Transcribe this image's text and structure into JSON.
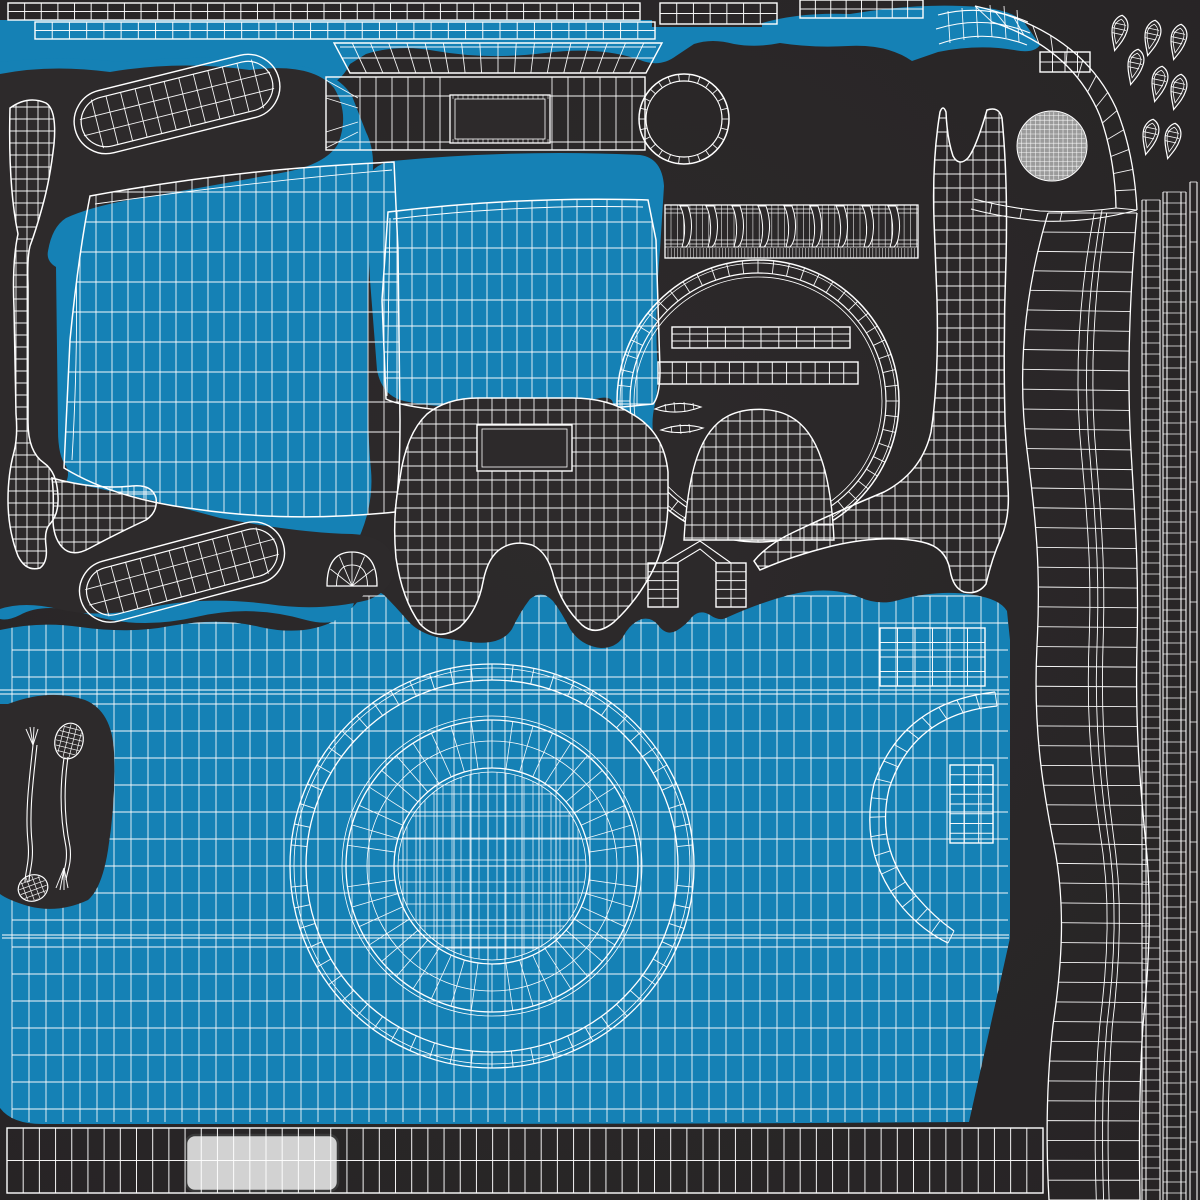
{
  "window": {
    "width": 1200,
    "height": 1200,
    "title": "uv-unwrap-texture-sheet"
  },
  "colors": {
    "bg": "#2d2a2b",
    "bgEdge": "#272425",
    "blue": "#1581b5",
    "line": "#ffffff",
    "ballFill": "#9b9b9b",
    "panel": "#d2d2d2",
    "panelStroke": "#3a3a3a"
  },
  "pieces": [
    {
      "name": "blue-top-band",
      "type": "blob",
      "fill": "blue",
      "d": "M0,20 L652,20 L652,27 L762,27 L762,23 Q800,12 850,14 Q910,4 962,6 Q1008,7 1024,22 L1040,45 Q1034,54 1014,50 Q978,44 938,52 L912,61 Q888,44 848,46 Q812,48 780,43 Q756,48 734,44 Q712,38 694,44 L676,56 Q660,68 640,60 Q600,46 545,53 Q488,60 436,51 Q398,44 366,54 L350,64 Q338,88 316,86 Q262,62 202,78 Q150,92 96,79 Q44,68 0,80 Z"
    },
    {
      "name": "blue-left-panel-region",
      "type": "blob",
      "fill": "blue",
      "d": "M0,62 Q60,55 120,62 Q220,52 300,66 Q338,73 352,96 L366,132 Q376,152 372,182 L368,300 Q366,420 371,470 Q374,505 358,540 Q346,564 352,584 Q358,600 350,612 Q336,628 306,620 Q252,604 196,617 Q140,630 90,615 Q45,601 20,615 Q8,621 0,619 Z"
    },
    {
      "name": "blue-center-panel-region",
      "type": "blob",
      "fill": "blue",
      "d": "M366,190 Q366,166 392,161 Q520,149 640,155 Q662,158 664,186 L660,250 Q655,310 657,355 Q659,388 655,404 Q650,424 655,444 Q656,461 645,467 Q629,469 622,452 Q611,428 613,406 Q614,396 600,398 Q540,410 480,408 Q430,407 404,401 Q382,396 377,370 L370,280 Z"
    },
    {
      "name": "blue-bottom-plate-region",
      "type": "blob",
      "fill": "blue",
      "d": "M0,630 Q40,621 80,627 Q130,634 170,626 Q220,617 260,627 Q300,636 330,623 Q347,615 359,600 Q371,585 384,595 Q396,607 408,621 Q420,634 441,638 L470,642 Q501,646 512,629 Q520,612 530,599 Q542,589 553,601 Q562,613 570,629 Q581,646 601,648 Q616,648 623,637 Q630,623 642,619 Q652,617 658,625 Q666,636 676,631 Q686,625 692,617 Q700,609 710,615 Q720,622 728,617 Q759,603 789,595 Q829,585 859,597 Q879,606 899,600 Q939,589 974,595 Q1000,599 1007,611 L1010,640 L1010,938 L969,1122 Q700,1124 400,1124 L42,1124 Q12,1124 0,1108 Z"
    },
    {
      "name": "dark-left-island-region",
      "type": "blob",
      "fill": "bg",
      "d": "M0,74 Q50,64 110,72 Q180,60 250,70 Q312,62 334,88 Q350,114 338,144 Q326,164 286,172 Q200,188 140,198 Q92,206 66,218 Q52,227 48,251 Q46,261 56,267 L58,430 Q58,456 66,466 Q70,474 66,482 Q140,496 220,518 Q300,533 352,534 Q388,536 394,560 Q398,588 368,600 Q320,612 268,604 Q205,596 152,607 Q98,619 58,609 Q24,601 0,609 Z"
    },
    {
      "name": "front-panel-mesh",
      "type": "clip-grid",
      "d": "M90,196 Q200,176 300,168 Q350,164 394,162 L398,250 L400,420 Q400,482 395,512 Q290,523 195,509 Q115,499 64,468 L70,340 Q78,258 90,196 Z",
      "x0": 64,
      "x1": 400,
      "sx": 16,
      "y0": 162,
      "y1": 523,
      "sy": 30,
      "extras": [
        "M95,204 Q250,182 392,170",
        "M74,210 Q80,320 72,460"
      ]
    },
    {
      "name": "center-panel-mesh",
      "type": "clip-grid",
      "d": "M388,212 Q520,196 648,200 L656,240 L660,370 Q660,396 653,404 Q540,416 440,410 Q400,406 386,399 L382,300 Z",
      "x0": 382,
      "x1": 660,
      "sx": 15,
      "y0": 196,
      "y1": 416,
      "sy": 26,
      "extras": [
        "M393,219 Q520,204 643,207",
        "M390,218 L387,396"
      ]
    },
    {
      "name": "bottom-plate-mesh",
      "type": "clip-grid",
      "clipRef": "blue-bottom-plate-region",
      "x0": 12,
      "x1": 1008,
      "sx": 17,
      "y0": 596,
      "y1": 1122,
      "sy": 27,
      "extras": [
        "M0,690 L1009,690",
        "M0,694 L1009,694",
        "M2,935 L1009,935",
        "M2,938 L1009,938"
      ]
    },
    {
      "name": "lens-mount-ring",
      "type": "mount-ring",
      "cx": 492,
      "cy": 866,
      "circles": [
        202,
        198,
        186,
        150,
        146,
        125,
        98,
        94
      ],
      "tickR1": 186,
      "tickR2": 202,
      "ticks": 60,
      "fanR1": 98,
      "fanR2": 146,
      "fan": 44,
      "innerR": 94,
      "innerSx": 9,
      "innerSy": 22
    },
    {
      "name": "plate-tab-grid",
      "type": "grid-rect",
      "x": 880,
      "y": 628,
      "w": 105,
      "h": 58,
      "cols": 6,
      "rows": 4
    },
    {
      "name": "dark-pins-region",
      "type": "blob",
      "fill": "bg",
      "d": "M8,704 Q50,688 85,700 Q112,711 114,752 Q116,800 108,850 Q102,888 88,900 Q58,914 28,906 Q8,900 0,894 L0,704 Z"
    },
    {
      "name": "pin-wands",
      "type": "pins",
      "left": {
        "fanBase": [
          33,
          745
        ],
        "fanTips": [
          [
            26,
            729
          ],
          [
            30,
            727
          ],
          [
            34,
            727
          ],
          [
            38,
            729
          ]
        ],
        "stem1": "M33,745 C29,782 25,812 28,842 C30,862 25,872 25,882",
        "stem2": "M37,745 C33,782 29,812 32,842 C34,862 29,872 29,882",
        "bulb": {
          "cx": 33,
          "cy": 888,
          "rx": 15,
          "ry": 13,
          "rot": -20
        }
      },
      "right": {
        "bulb": {
          "cx": 69,
          "cy": 741,
          "rx": 14,
          "ry": 18,
          "rot": 14
        },
        "stem1": "M64,758 C59,792 61,822 66,847 C68,863 63,872 62,880",
        "stem2": "M68,757 C63,792 65,822 70,847 C72,863 67,872 66,880",
        "fanBase": [
          64,
          868
        ],
        "fanTips": [
          [
            56,
            888
          ],
          [
            60,
            890
          ],
          [
            64,
            890
          ],
          [
            68,
            888
          ]
        ]
      }
    },
    {
      "name": "grip-pill-upper",
      "type": "pill",
      "cx": 177,
      "cy": 104,
      "len": 196,
      "h": 50,
      "rot": -14
    },
    {
      "name": "grip-pill-lower",
      "type": "pill",
      "cx": 182,
      "cy": 572,
      "len": 196,
      "h": 48,
      "rot": -15
    },
    {
      "name": "left-hook-strip-mesh",
      "type": "clip-grid",
      "d": "M10,108 Q28,95 46,103 Q57,110 54,144 Q50,180 42,208 Q36,230 30,246 Q27,258 28,286 L28,422 Q28,452 44,463 Q57,472 58,496 Q59,514 50,524 Q44,530 46,546 Q48,562 40,568 Q26,572 18,556 Q8,530 8,500 Q8,474 14,452 Q18,436 16,414 L14,308 Q12,262 18,234 Q8,186 10,108 Z",
      "x0": 5,
      "x1": 60,
      "sx": 11,
      "y0": 95,
      "y1": 580,
      "sy": 12,
      "extras": []
    },
    {
      "name": "left-hook-arm-mesh",
      "type": "clip-grid",
      "d": "M52,478 Q95,490 132,486 Q152,484 156,498 Q158,512 146,520 Q116,534 90,548 Q72,558 62,547 Q52,536 53,514 Q54,494 52,478 Z",
      "x0": 50,
      "x1": 160,
      "sx": 12,
      "y0": 470,
      "y1": 560,
      "sy": 12,
      "extras": []
    },
    {
      "name": "strip-top-1",
      "type": "grid-rect",
      "x": 8,
      "y": 3,
      "w": 632,
      "h": 17,
      "cols": 38,
      "rows": 2
    },
    {
      "name": "strip-top-2",
      "type": "grid-rect",
      "x": 660,
      "y": 3,
      "w": 117,
      "h": 21,
      "cols": 7,
      "rows": 2
    },
    {
      "name": "strip-top-3",
      "type": "grid-rect",
      "x": 800,
      "y": 0,
      "w": 123,
      "h": 18,
      "cols": 8,
      "rows": 2
    },
    {
      "name": "strip-upper-blue",
      "type": "grid-rect",
      "x": 35,
      "y": 22,
      "w": 620,
      "h": 17,
      "cols": 36,
      "rows": 2
    },
    {
      "name": "strip-under-wing",
      "type": "grid-rect",
      "x": 1040,
      "y": 52,
      "w": 50,
      "h": 20,
      "cols": 4,
      "rows": 2
    },
    {
      "name": "wing-grid",
      "type": "connectors",
      "paths": [
        "M938,15 Q984,3 1028,22",
        "M936,29 Q984,14 1030,33",
        "M939,44 Q984,28 1027,45"
      ],
      "ticks": [
        [
          948,
          11,
          950,
          43
        ],
        [
          962,
          8,
          964,
          40
        ],
        [
          976,
          6,
          978,
          38
        ],
        [
          990,
          5,
          992,
          37
        ],
        [
          1004,
          6,
          1006,
          38
        ],
        [
          1017,
          10,
          1019,
          42
        ]
      ]
    },
    {
      "name": "top-bar-upper",
      "type": "trap-grid",
      "pts": [
        [
          334,
          43
        ],
        [
          662,
          43
        ],
        [
          646,
          73
        ],
        [
          350,
          73
        ]
      ],
      "cols": 18
    },
    {
      "name": "top-bar-main",
      "type": "bar-main",
      "x": 326,
      "y": 77,
      "w": 319,
      "h": 73,
      "hole": [
        450,
        95,
        100,
        48
      ]
    },
    {
      "name": "eyelet-ring",
      "type": "ring",
      "cx": 684,
      "cy": 119,
      "rOut": 45,
      "rIn": 38,
      "ticks": 26
    },
    {
      "name": "serrated-strip",
      "type": "serrated",
      "x": 665,
      "y": 205,
      "w": 253,
      "h": 53,
      "teeth": 9
    },
    {
      "name": "lens-dial-ring",
      "type": "ring",
      "cx": 758,
      "cy": 401,
      "rOut": 141,
      "rIn": 128,
      "ticks": 56,
      "double": true
    },
    {
      "name": "lens-slat-1",
      "type": "grid-rect",
      "x": 672,
      "y": 327,
      "w": 178,
      "h": 21,
      "cols": 10,
      "rows": 3
    },
    {
      "name": "lens-slat-2",
      "type": "grid-rect",
      "x": 658,
      "y": 362,
      "w": 200,
      "h": 22,
      "cols": 14,
      "rows": 2
    },
    {
      "name": "crescent-1",
      "type": "crescent",
      "d": "M655,409 Q677,399 701,407 Q678,416 655,409 Z",
      "ticks": [
        [
          665,
          404,
          666,
          411
        ],
        [
          674,
          402,
          675,
          412
        ],
        [
          684,
          402,
          685,
          412
        ],
        [
          693,
          403,
          694,
          410
        ]
      ]
    },
    {
      "name": "crescent-2",
      "type": "crescent",
      "d": "M661,430 Q682,422 703,428 Q682,436 661,430 Z",
      "ticks": [
        [
          671,
          426,
          672,
          433
        ],
        [
          680,
          424,
          681,
          434
        ],
        [
          689,
          424,
          690,
          433
        ]
      ]
    },
    {
      "name": "lens-bell-mesh",
      "type": "bell",
      "d": "M684,540 C688,468 701,430 728,416 C746,407 774,407 791,417 C818,432 831,474 834,540 Z",
      "x0": 684,
      "x1": 834,
      "sx": 12,
      "y0": 407,
      "y1": 540,
      "sy": 13
    },
    {
      "name": "shutter-mask-mesh",
      "type": "mask",
      "d": "M478,398 L572,398 Q608,398 632,414 Q664,432 668,472 L668,500 Q668,542 651,574 Q635,603 614,622 Q596,637 582,625 Q562,606 554,578 Q548,552 532,545 Q515,540 502,548 Q488,556 483,582 Q478,610 460,627 Q438,643 420,624 Q402,599 396,558 Q392,516 400,478 Q406,434 427,414 Q447,398 478,398 Z",
      "x0": 394,
      "x1": 670,
      "sx": 14,
      "y0": 396,
      "y1": 634,
      "sy": 14,
      "hole": [
        477,
        425,
        95,
        46
      ]
    },
    {
      "name": "small-dome-mesh",
      "type": "fan-dome",
      "cx": 352,
      "cy": 586,
      "rx": 25,
      "ry": 34,
      "spokes": 6
    },
    {
      "name": "box-1",
      "type": "grid-rect",
      "x": 648,
      "y": 563,
      "w": 30,
      "h": 44,
      "cols": 2,
      "rows": 5
    },
    {
      "name": "box-2",
      "type": "grid-rect",
      "x": 716,
      "y": 563,
      "w": 30,
      "h": 44,
      "cols": 2,
      "rows": 5
    },
    {
      "name": "box-connectors",
      "type": "connectors",
      "paths": [
        "M663,563 L700,541 L731,563",
        "M677,563 L700,549 L717,563"
      ],
      "ticks": []
    },
    {
      "name": "wrench-mesh",
      "type": "clip-grid",
      "d": "M940,112 Q932,160 934,220 L937,300 Q939,380 931,432 Q922,472 884,492 Q836,512 794,532 Q768,544 754,561 L760,570 Q792,556 832,546 Q884,534 922,542 Q946,547 950,570 Q953,588 964,592 Q978,595 986,584 Q992,558 1001,538 Q1010,518 1008,488 L1005,420 Q1003,340 1006,260 Q1008,180 1002,118 Q999,106 987,110 Q976,148 968,158 Q959,167 953,156 Q947,138 946,112 Q943,104 940,112 Z",
      "x0": 752,
      "x1": 1010,
      "sx": 13,
      "y0": 104,
      "y1": 596,
      "sy": 14,
      "extras": []
    },
    {
      "name": "top-right-arc-band",
      "type": "band",
      "edgeA": "M975,6 Q1080,30 1116,108 Q1134,152 1137,210",
      "edgeB": "M992,22 Q1072,48 1100,116 Q1115,158 1116,208",
      "rungs": 14,
      "mids": []
    },
    {
      "name": "arc-band-tail",
      "type": "connectors",
      "paths": [
        "M1137,210 Q1090,223 1040,221 Q1000,217 971,209",
        "M1116,208 Q1080,213 1040,211 Q1004,207 974,199"
      ],
      "ticks": [
        [
          1100,
          221,
          1102,
          210
        ],
        [
          1060,
          221,
          1062,
          212
        ],
        [
          1020,
          218,
          1022,
          208
        ],
        [
          990,
          213,
          992,
          203
        ]
      ]
    },
    {
      "name": "side-ridge-band",
      "type": "band",
      "edgeA": "M1048,213 C1022,300 1018,380 1027,450 C1036,520 1041,570 1037,645 C1033,725 1042,785 1054,845 C1066,905 1062,965 1053,1025 C1046,1085 1046,1145 1049,1200",
      "edgeB": "M1137,213 C1129,300 1127,380 1131,450 C1135,520 1139,570 1137,645 C1135,725 1140,785 1146,845 C1152,905 1149,965 1143,1025 C1139,1085 1139,1145 1140,1200",
      "rungs": 50,
      "mids": [
        0.52,
        0.6,
        0.66
      ]
    },
    {
      "name": "c-ring-band",
      "type": "band",
      "edgeA": "M995,692 Q902,702 874,784 Q858,854 903,908 Q923,931 948,943",
      "edgeB": "M997,706 Q913,714 889,789 Q875,849 917,897 Q934,917 954,931",
      "rungs": 18,
      "mids": []
    },
    {
      "name": "c-inner-grid",
      "type": "grid-rect",
      "x": 950,
      "y": 765,
      "w": 43,
      "h": 78,
      "cols": 3,
      "rows": 8
    },
    {
      "name": "right-rail-a",
      "type": "vstrips",
      "xs": [
        1142,
        1146,
        1160
      ],
      "y0": 200,
      "y1": 1200,
      "rungStep": 11
    },
    {
      "name": "right-rail-b",
      "type": "vstrips",
      "xs": [
        1163,
        1167,
        1181,
        1186
      ],
      "y0": 192,
      "y1": 1200,
      "rungStep": 11
    },
    {
      "name": "right-rail-c",
      "type": "vstrips",
      "xs": [
        1190,
        1197
      ],
      "y0": 182,
      "y1": 1200,
      "rungStep": 30
    },
    {
      "name": "sphere-knob",
      "type": "ball",
      "cx": 1052,
      "cy": 146,
      "r": 35,
      "step": 4.6
    },
    {
      "name": "rivet-drops",
      "type": "tears",
      "rot": 12,
      "pts": [
        [
          1119,
          30
        ],
        [
          1152,
          35
        ],
        [
          1178,
          39
        ],
        [
          1135,
          64
        ],
        [
          1159,
          81
        ],
        [
          1178,
          89
        ],
        [
          1150,
          134
        ],
        [
          1172,
          138
        ]
      ]
    },
    {
      "name": "bottom-light-panel",
      "type": "round-rect-light",
      "x": 186,
      "y": 1135,
      "w": 152,
      "h": 56,
      "r": 9
    },
    {
      "name": "bottom-strip",
      "type": "grid-rect",
      "x": 7,
      "y": 1128,
      "w": 1036,
      "h": 65,
      "cols": 64,
      "rows": 2
    }
  ]
}
